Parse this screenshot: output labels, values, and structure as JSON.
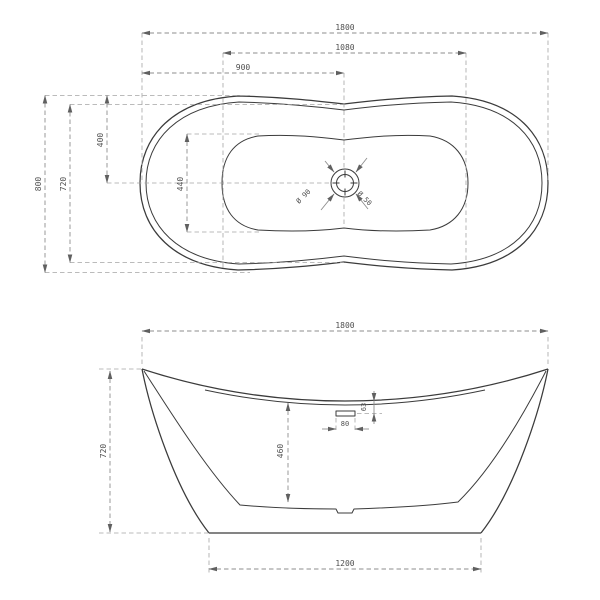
{
  "drawing": {
    "title": "freestanding-bathtub-dimension-drawing",
    "colors": {
      "background": "#ffffff",
      "object_line": "#3b3b3b",
      "dimension_line": "#8e8e8e",
      "extension_line": "#a5a5a5",
      "dimension_text": "#4f4f4f"
    },
    "top_view": {
      "dims": {
        "overall_length": "1800",
        "basin_length": "1080",
        "drain_center_from_left": "900",
        "overall_width": "800",
        "waist_width": "720",
        "rim_to_center": "400",
        "basin_width": "440",
        "drain_outer_dia": "Ø 90",
        "drain_inner_dia": "Ø 50"
      }
    },
    "front_view": {
      "dims": {
        "overall_length": "1800",
        "overall_height": "720",
        "inner_depth": "460",
        "overflow_drop": "63",
        "overflow_width": "80",
        "base_length": "1200"
      }
    }
  }
}
